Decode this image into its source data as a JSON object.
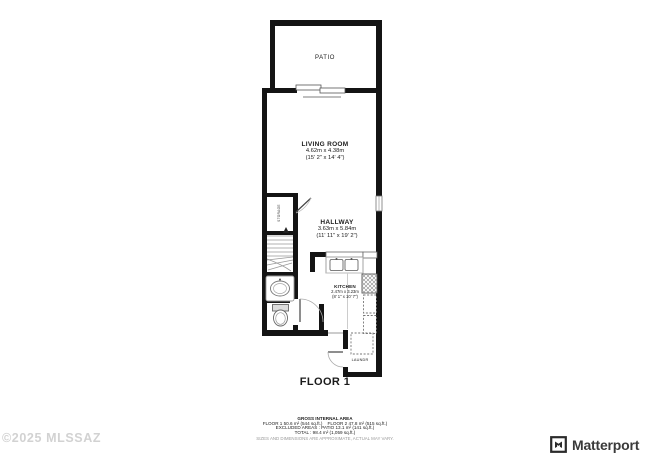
{
  "plan": {
    "floor_label": "FLOOR 1",
    "rooms": {
      "patio": {
        "name": "PATIO"
      },
      "living_room": {
        "name": "LIVING ROOM",
        "metric": "4.62m x 4.38m",
        "imperial": "(15' 2\" x 14' 4\")"
      },
      "hallway": {
        "name": "HALLWAY",
        "metric": "3.63m x 5.84m",
        "imperial": "(11' 11\" x 19' 2\")"
      },
      "kitchen": {
        "name": "KITCHEN",
        "metric": "2.47m x 3.23m",
        "imperial": "(8' 1\" x 10' 7\")"
      },
      "laundry": {
        "name": "LAUNDR"
      },
      "storage": {
        "name": "STORAGE"
      }
    }
  },
  "summary": {
    "title": "GROSS INTERNAL AREA",
    "line1": "FLOOR 1 50.6 m² (544 sq.ft.)    FLOOR 2 47.8 m² (515 sq.ft.)",
    "line2": "EXCLUDED AREAS :  PATIO 13.1 m² (141 sq.ft.)",
    "line3": "TOTAL :  98.4 m² (1,059 sq.ft.)",
    "disclaimer": "SIZES AND DIMENSIONS ARE APPROXIMATE, ACTUAL MAY VARY."
  },
  "watermark": "©2025 MLSSAZ",
  "branding": {
    "logo_text": "Matterport"
  },
  "colors": {
    "wall": "#141414",
    "fixture": "#8c8c8c",
    "dashed_outline": "#777777",
    "watermark": "#d2d2d2",
    "logo": "#3a3a3a"
  }
}
